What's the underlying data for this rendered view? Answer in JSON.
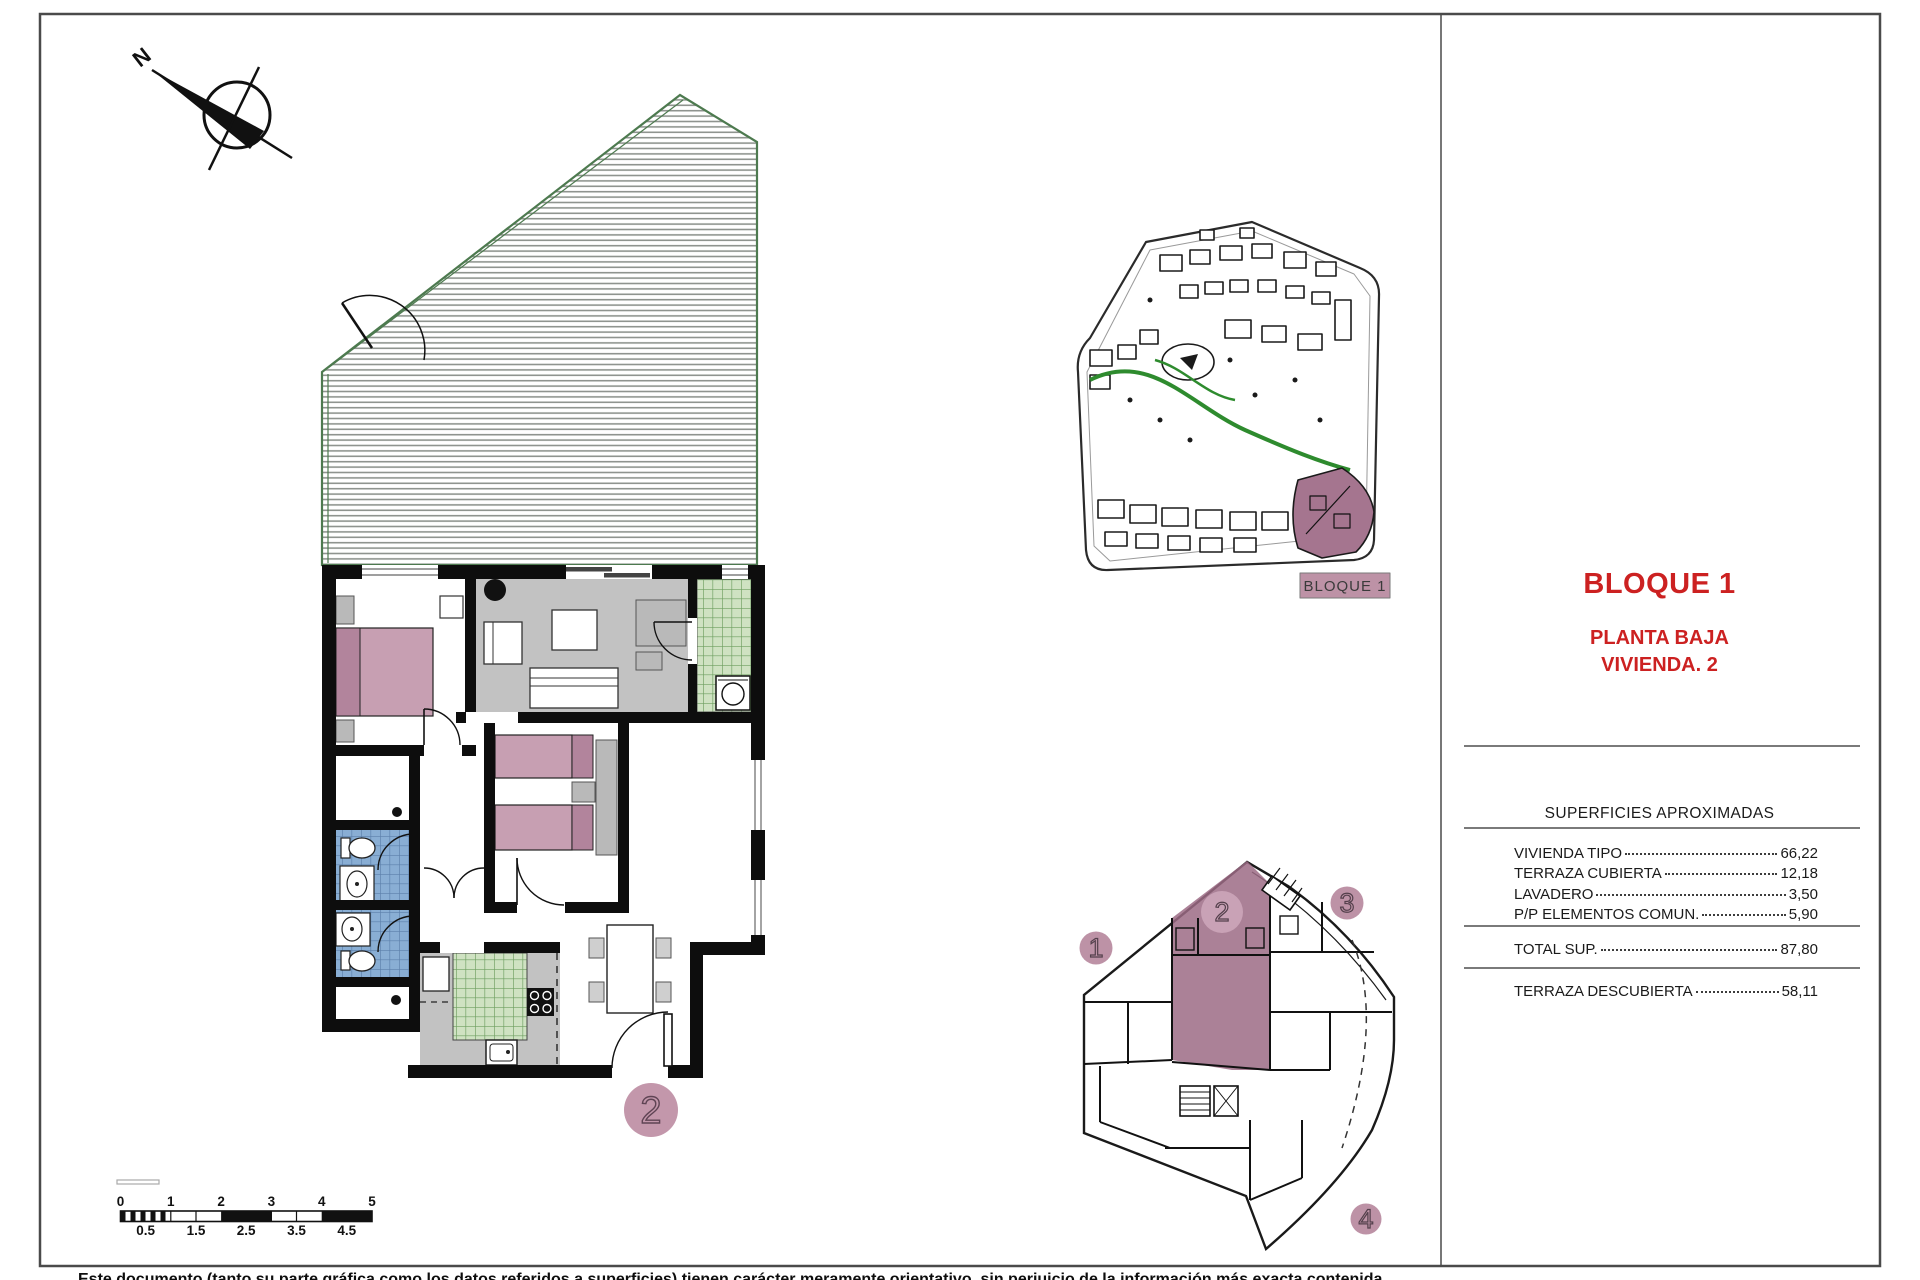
{
  "compass": {
    "north_label": "N"
  },
  "main_plan": {
    "unit_badge": "2"
  },
  "site_plan": {
    "label": "BLOQUE 1"
  },
  "block_plan": {
    "units": [
      "1",
      "2",
      "3",
      "4"
    ]
  },
  "panel": {
    "title": "BLOQUE 1",
    "subtitle1": "PLANTA BAJA",
    "subtitle2": "VIVIENDA. 2",
    "table_title": "SUPERFICIES APROXIMADAS",
    "rows": [
      {
        "label": "VIVIENDA TIPO",
        "value": "66,22"
      },
      {
        "label": "TERRAZA CUBIERTA",
        "value": "12,18"
      },
      {
        "label": "LAVADERO",
        "value": "3,50"
      },
      {
        "label": "P/P ELEMENTOS COMUN.",
        "value": "5,90"
      }
    ],
    "total": {
      "label": "TOTAL SUP.",
      "value": "87,80"
    },
    "extra": {
      "label": "TERRAZA DESCUBIERTA",
      "value": "58,11"
    }
  },
  "scalebar": {
    "top": [
      "0",
      "1",
      "2",
      "3",
      "4",
      "5"
    ],
    "bottom": [
      "0.5",
      "1.5",
      "2.5",
      "3.5",
      "4.5"
    ]
  },
  "footer": {
    "disclaimer": "Este documento (tanto su parte gráfica como los datos referidos a superficies) tienen carácter meramente orientativo, sin perjuicio de la información más exacta contenida"
  },
  "colors": {
    "accent_red": "#cc2121",
    "highlight_mauve": "#9c6b85",
    "badge_pink": "#bd92a6",
    "furniture_pink": "#c79fb2",
    "pillow_pink": "#b2849c",
    "floor_gray": "#c2c2c2",
    "tile_green": "#cfe2c2",
    "tile_blue": "#89aed4",
    "path_green": "#2e8b2e",
    "terrace_edge_green": "#4d7a4f"
  }
}
